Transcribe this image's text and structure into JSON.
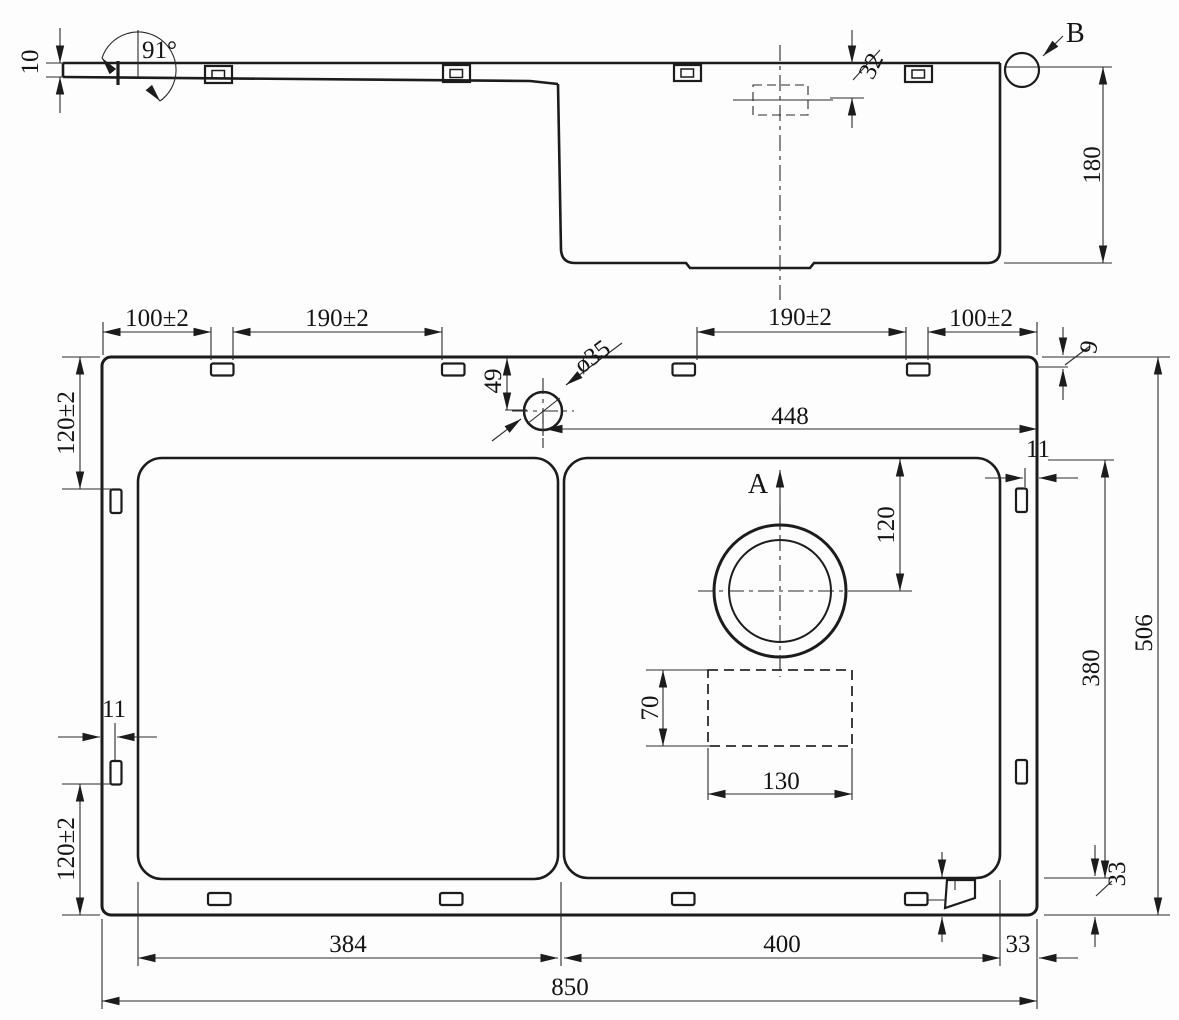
{
  "profile": {
    "thickness": "10",
    "angle": "91°",
    "offset_32": "32",
    "depth_180": "180",
    "detail_b": "B"
  },
  "plan": {
    "top_dims": [
      "100±2",
      "190±2",
      "190±2",
      "100±2"
    ],
    "rim_offset_9": "9",
    "tap_offset_49": "49",
    "tap_diameter": "ø35",
    "tap_to_edge_448": "448",
    "right_gap_11": "11",
    "section_a": "A",
    "drain_offset_120": "120",
    "bowl_depth_380": "380",
    "overall_506": "506",
    "left_top_120": "120±2",
    "left_gap_11": "11",
    "left_bottom_120": "120±2",
    "box_70": "70",
    "box_130": "130",
    "right_rim_33": "33",
    "bowl_left_384": "384",
    "bowl_right_400": "400",
    "rim_33": "33",
    "overall_850": "850"
  }
}
